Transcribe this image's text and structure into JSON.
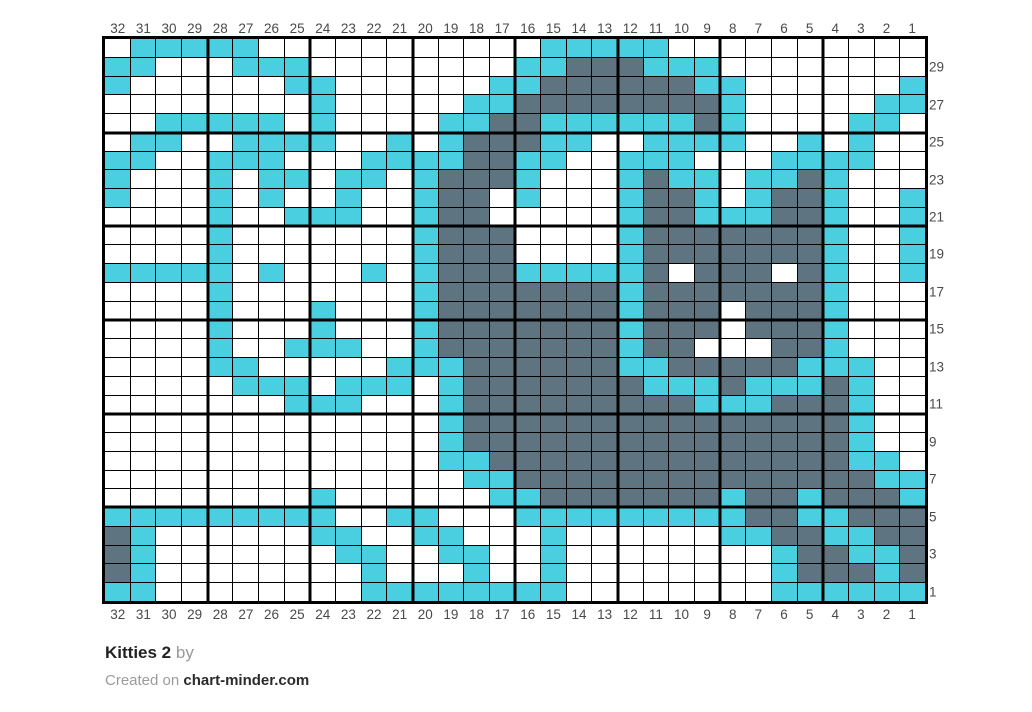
{
  "title": {
    "name": "Kitties 2",
    "by_label": "by"
  },
  "footer": {
    "created_prefix": "Created on ",
    "site": "chart-minder.com"
  },
  "colors": {
    "cyan": "#4acfe0",
    "dark_gray": "#5e7481",
    "white": "#ffffff",
    "gridline": "#000000",
    "label_text": "#4a4a4a"
  },
  "axis": {
    "top": [
      "32",
      "31",
      "30",
      "29",
      "28",
      "27",
      "26",
      "25",
      "24",
      "23",
      "22",
      "21",
      "20",
      "19",
      "18",
      "17",
      "16",
      "15",
      "14",
      "13",
      "12",
      "11",
      "10",
      "9",
      "8",
      "7",
      "6",
      "5",
      "4",
      "3",
      "2",
      "1"
    ],
    "bottom": [
      "32",
      "31",
      "30",
      "29",
      "28",
      "27",
      "26",
      "25",
      "24",
      "23",
      "22",
      "21",
      "20",
      "19",
      "18",
      "17",
      "16",
      "15",
      "14",
      "13",
      "12",
      "11",
      "10",
      "9",
      "8",
      "7",
      "6",
      "5",
      "4",
      "3",
      "2",
      "1"
    ],
    "left": [
      "30",
      "28",
      "26",
      "24",
      "22",
      "20",
      "18",
      "16",
      "14",
      "12",
      "10",
      "8",
      "6",
      "4",
      "2"
    ],
    "right": [
      "29",
      "27",
      "25",
      "23",
      "21",
      "19",
      "17",
      "15",
      "13",
      "11",
      "9",
      "7",
      "5",
      "3",
      "1"
    ]
  },
  "chart_data": {
    "type": "heatmap",
    "title": "Kitties 2",
    "columns": 32,
    "rows": 30,
    "column_labels_order": "32 at left to 1 at right",
    "row_order": "top string is row 30, last string is row 1",
    "legend": {
      "W": "white / empty stitch",
      "C": "cyan #4acfe0",
      "D": "dark gray #5e7481"
    },
    "thick_line_every_columns": 4,
    "thick_line_every_rows": 5,
    "grid": [
      "WCCCCCWWWWWWWWWWWCCCCCWWWWWWWWWW",
      "CCWWWCCCWWWWWWWWCCDDDCCCWWWWWWWW",
      "CWWWWWWCCWWWWWWCCDDDDDDCCWWWWWWC",
      "WWWWWWWWCWWWWWCCDDDDDDDDCWWWWWCC",
      "WWCCCCCWCWWWWCCDDCCCCCCDCWWWWCCW",
      "WCCWWCCCCWWCWCDDDCCWWCCCCWWCWCWW",
      "CCWWCCCWWWCCCCDDCCWWCCCWWWCCCCWW",
      "CWWWCWCCWCCWCDDDCWWWCDCCWCCDCWWW",
      "CWWWCWCWWCWWCDDWCWWWCDDCWCDDCWWC",
      "WWWWCWWCCCWWCDDWWWWWCDDCCCDDCWWC",
      "WWWWCWWWWWWWCDDDWWWWCDDDDDDDCWWC",
      "WWWWCWWWWWWWCDDDWWWWCDDDDDDDCWWC",
      "CCCCCWCWWWCWCDDDCCCCCDWDDDWDCWWC",
      "WWWWCWWWWWWWCDDDDDDDCDDDDDDDCWWW",
      "WWWWCWWWCWWWCDDDDDDDCDDDWDDDCWWW",
      "WWWWCWWWCWWWCDDDDDDDCDDDWDDDCWWW",
      "WWWWCWWCCCWWCDDDDDDDCDDWWWDDCWWW",
      "WWWWCCWWWWWCCCDDDDDDCCDDDDDCCCWW",
      "WWWWWCCCWCCCWCDDDDDDDCCCDCCCDCWW",
      "WWWWWWWCCCWWWCDDDDDDDDDCCCDDDCWW",
      "WWWWWWWWWWWWWCDDDDDDDDDDDDDDDCWW",
      "WWWWWWWWWWWWWCDDDDDDDDDDDDDDDCWW",
      "WWWWWWWWWWWWWCCDDDDDDDDDDDDDDCCW",
      "WWWWWWWWWWWWWWCCDDDDDDDDDDDDDDCC",
      "WWWWWWWWCWWWWWWCCDDDDDDDCDDCDDDC",
      "CCCCCCCCCWWCCWWWCCCCCCCCCDDCCDDD",
      "DCWWWWWWCCWWCCWWWCWWWWWWCCDDCCDD",
      "DCWWWWWWWCCWWCCWWCWWWWWWWWCDDCCD",
      "DCWWWWWWWWCWWWCWWCWWWWWWWWCDDDCD",
      "CCWWWWWWWWCCCCCCCCWWWWWWWWCCCCCC"
    ]
  }
}
